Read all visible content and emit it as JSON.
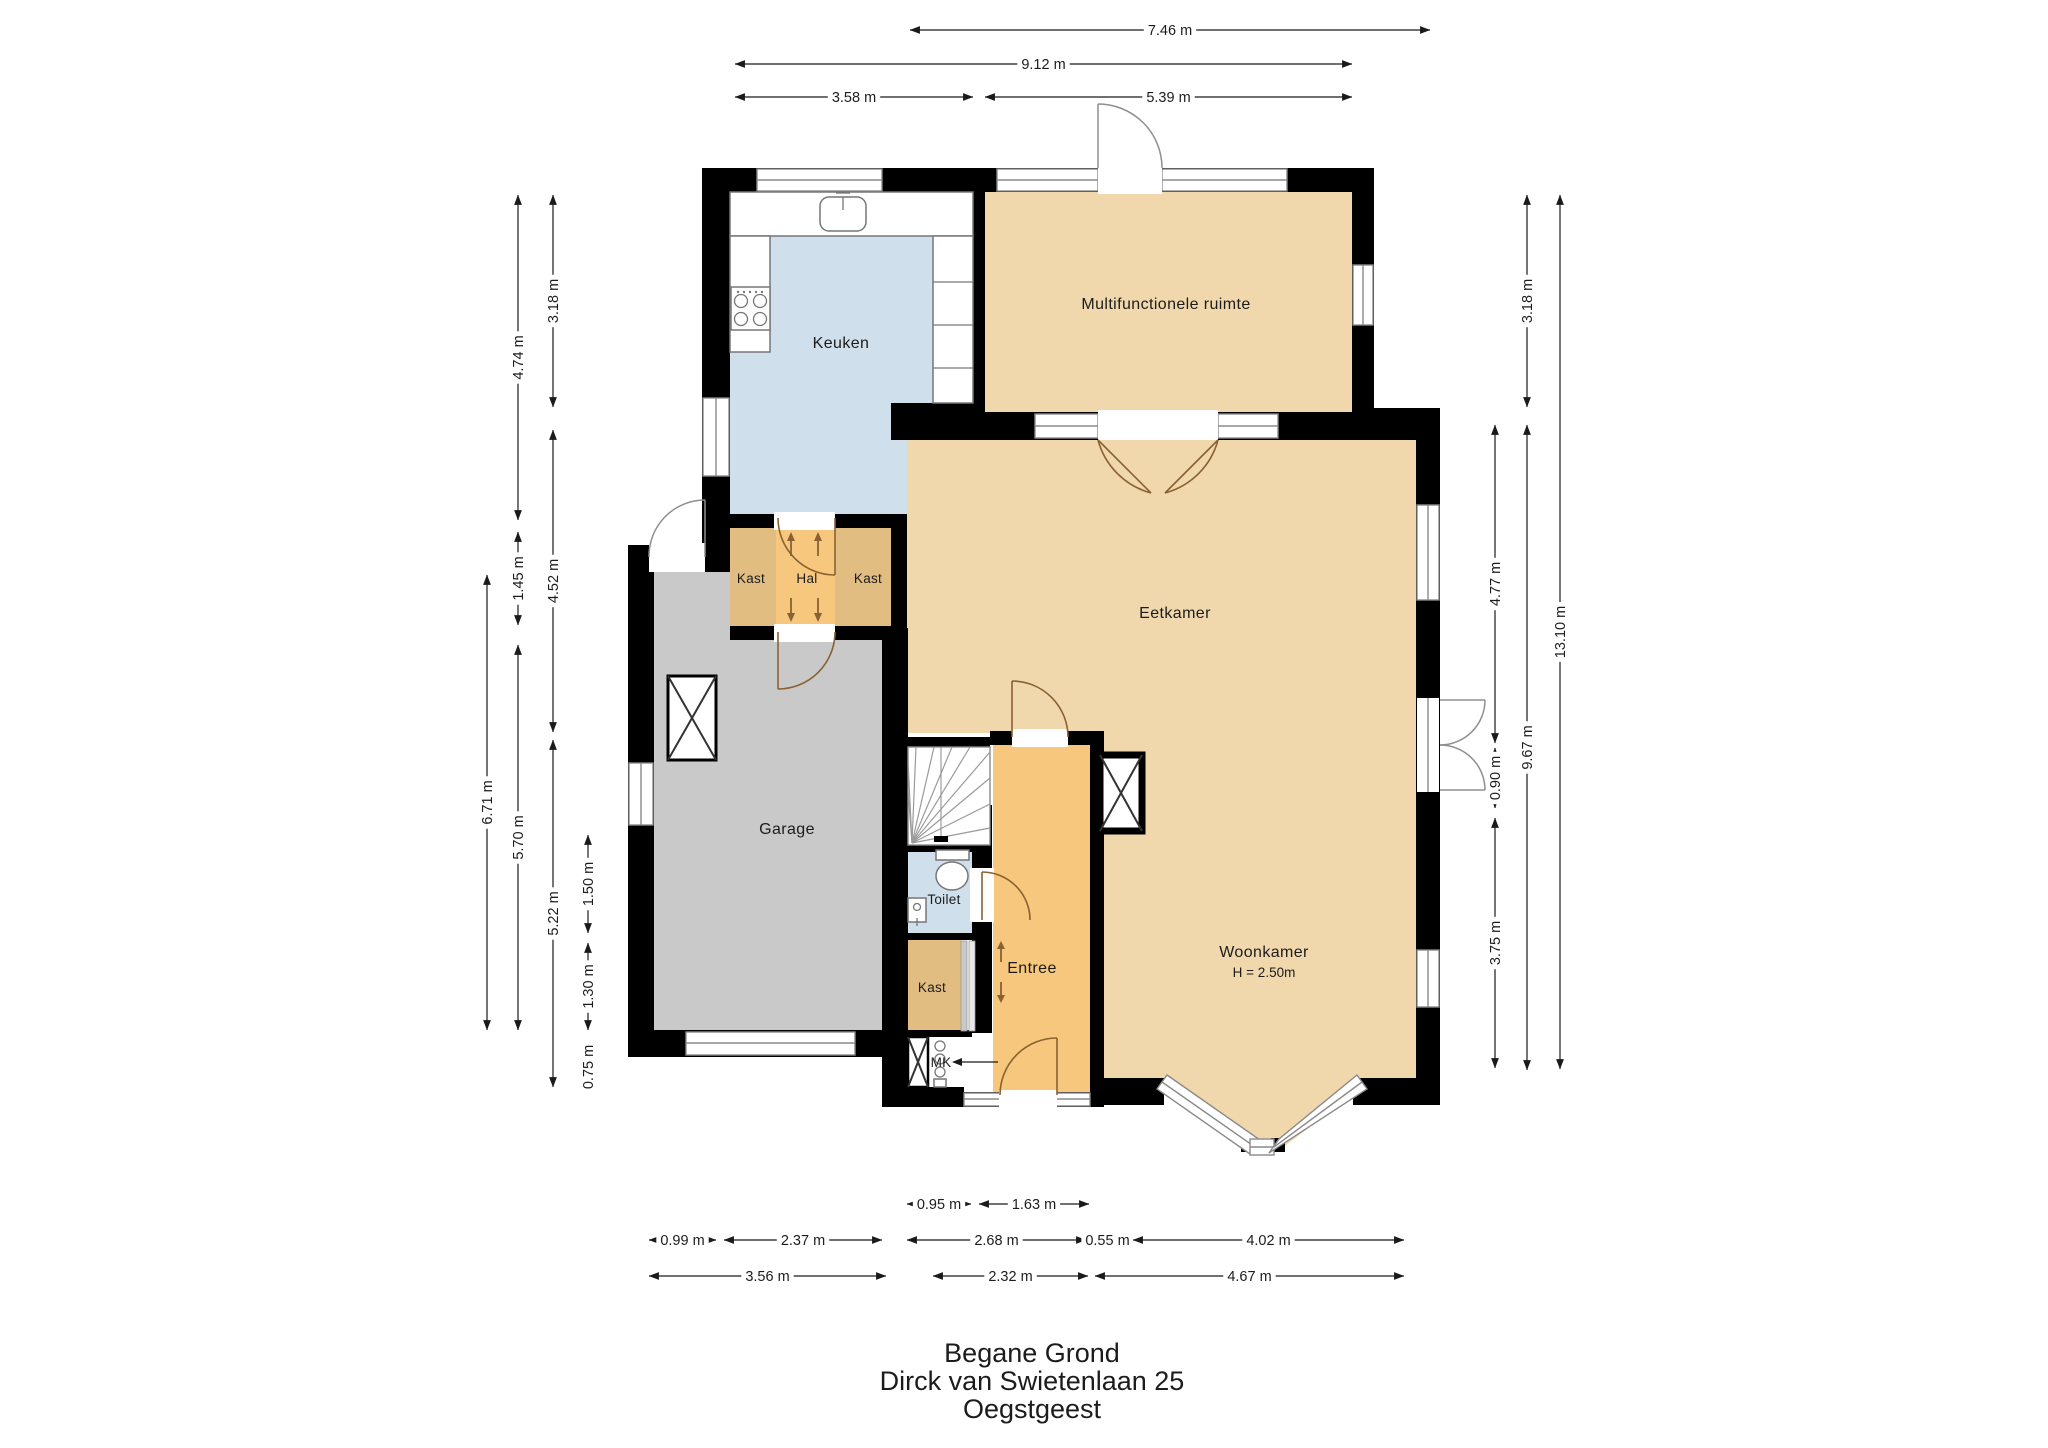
{
  "title": {
    "lines": [
      "Begane Grond",
      "Dirck van Swietenlaan 25",
      "Oegstgeest"
    ]
  },
  "rooms": {
    "keuken": "Keuken",
    "multifunctionele": "Multifunctionele ruimte",
    "kast_left": "Kast",
    "hal": "Hal",
    "kast_right": "Kast",
    "eetkamer": "Eetkamer",
    "garage": "Garage",
    "toilet": "Toilet",
    "entree": "Entree",
    "kast_entree": "Kast",
    "woonkamer": "Woonkamer",
    "woonkamer_height": "H = 2.50m",
    "mk": "MK"
  },
  "dimensions": {
    "top": [
      "7.46 m",
      "9.12 m",
      "3.58 m",
      "5.39 m"
    ],
    "left": [
      "3.18 m",
      "4.74 m",
      "4.52 m",
      "1.45 m",
      "6.71 m",
      "5.70 m",
      "5.22 m",
      "1.50 m",
      "1.30 m",
      "0.75 m"
    ],
    "right": [
      "3.18 m",
      "13.10 m",
      "4.77 m",
      "9.67 m",
      "0.90 m",
      "3.75 m"
    ],
    "bottom": [
      "0.95 m",
      "1.63 m",
      "0.99 m",
      "2.37 m",
      "2.68 m",
      "0.55 m",
      "4.02 m",
      "3.56 m",
      "2.32 m",
      "4.67 m"
    ]
  },
  "colors": {
    "wall": "#000000",
    "floor_tan": "#f0d8ac",
    "floor_orange": "#f6c77c",
    "floor_tan_dark": "#e2bd82",
    "floor_blue": "#cfdfeb",
    "floor_gray": "#c9c9c9",
    "window_line": "#8a8a8a",
    "door_arc_brown": "#8a6132",
    "door_arc_gray": "#8f8f8f",
    "text": "#1c1c1c"
  },
  "fixtures": {
    "garage_skylight": "x-box",
    "fireplace_shaft": "x-box",
    "stairs": "winder-stairs",
    "toilet_fixture": "toilet",
    "kitchen_sink": "sink",
    "cooktop": "4-burner-cooktop",
    "meter_cupboard": "MK"
  }
}
